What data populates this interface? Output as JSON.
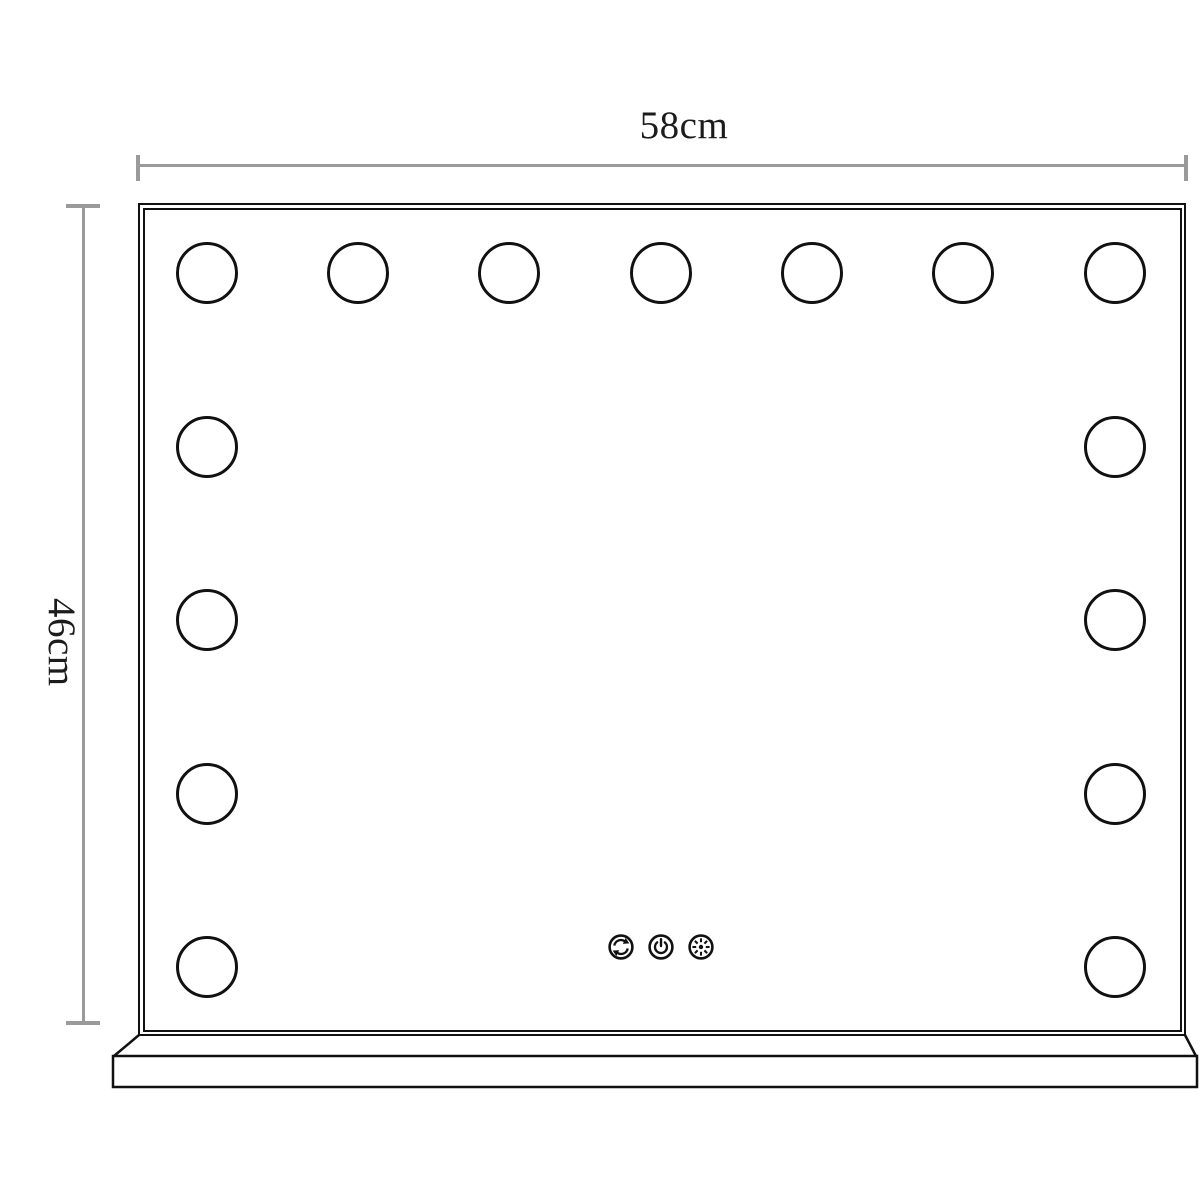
{
  "diagram": {
    "type": "product-dimension-drawing",
    "subject": "hollywood-vanity-mirror-with-stand",
    "width_label": "58cm",
    "height_label": "46cm",
    "bulbs": {
      "total": 15,
      "top_row": 7,
      "left_column": 5,
      "right_column": 5
    },
    "control_icons": [
      {
        "name": "auto-cycle-icon"
      },
      {
        "name": "power-icon"
      },
      {
        "name": "brightness-icon"
      }
    ],
    "colors": {
      "outline": "#111111",
      "dimension_line": "#9a9a9a",
      "label_text": "#1c1c1c",
      "background": "#ffffff"
    }
  }
}
